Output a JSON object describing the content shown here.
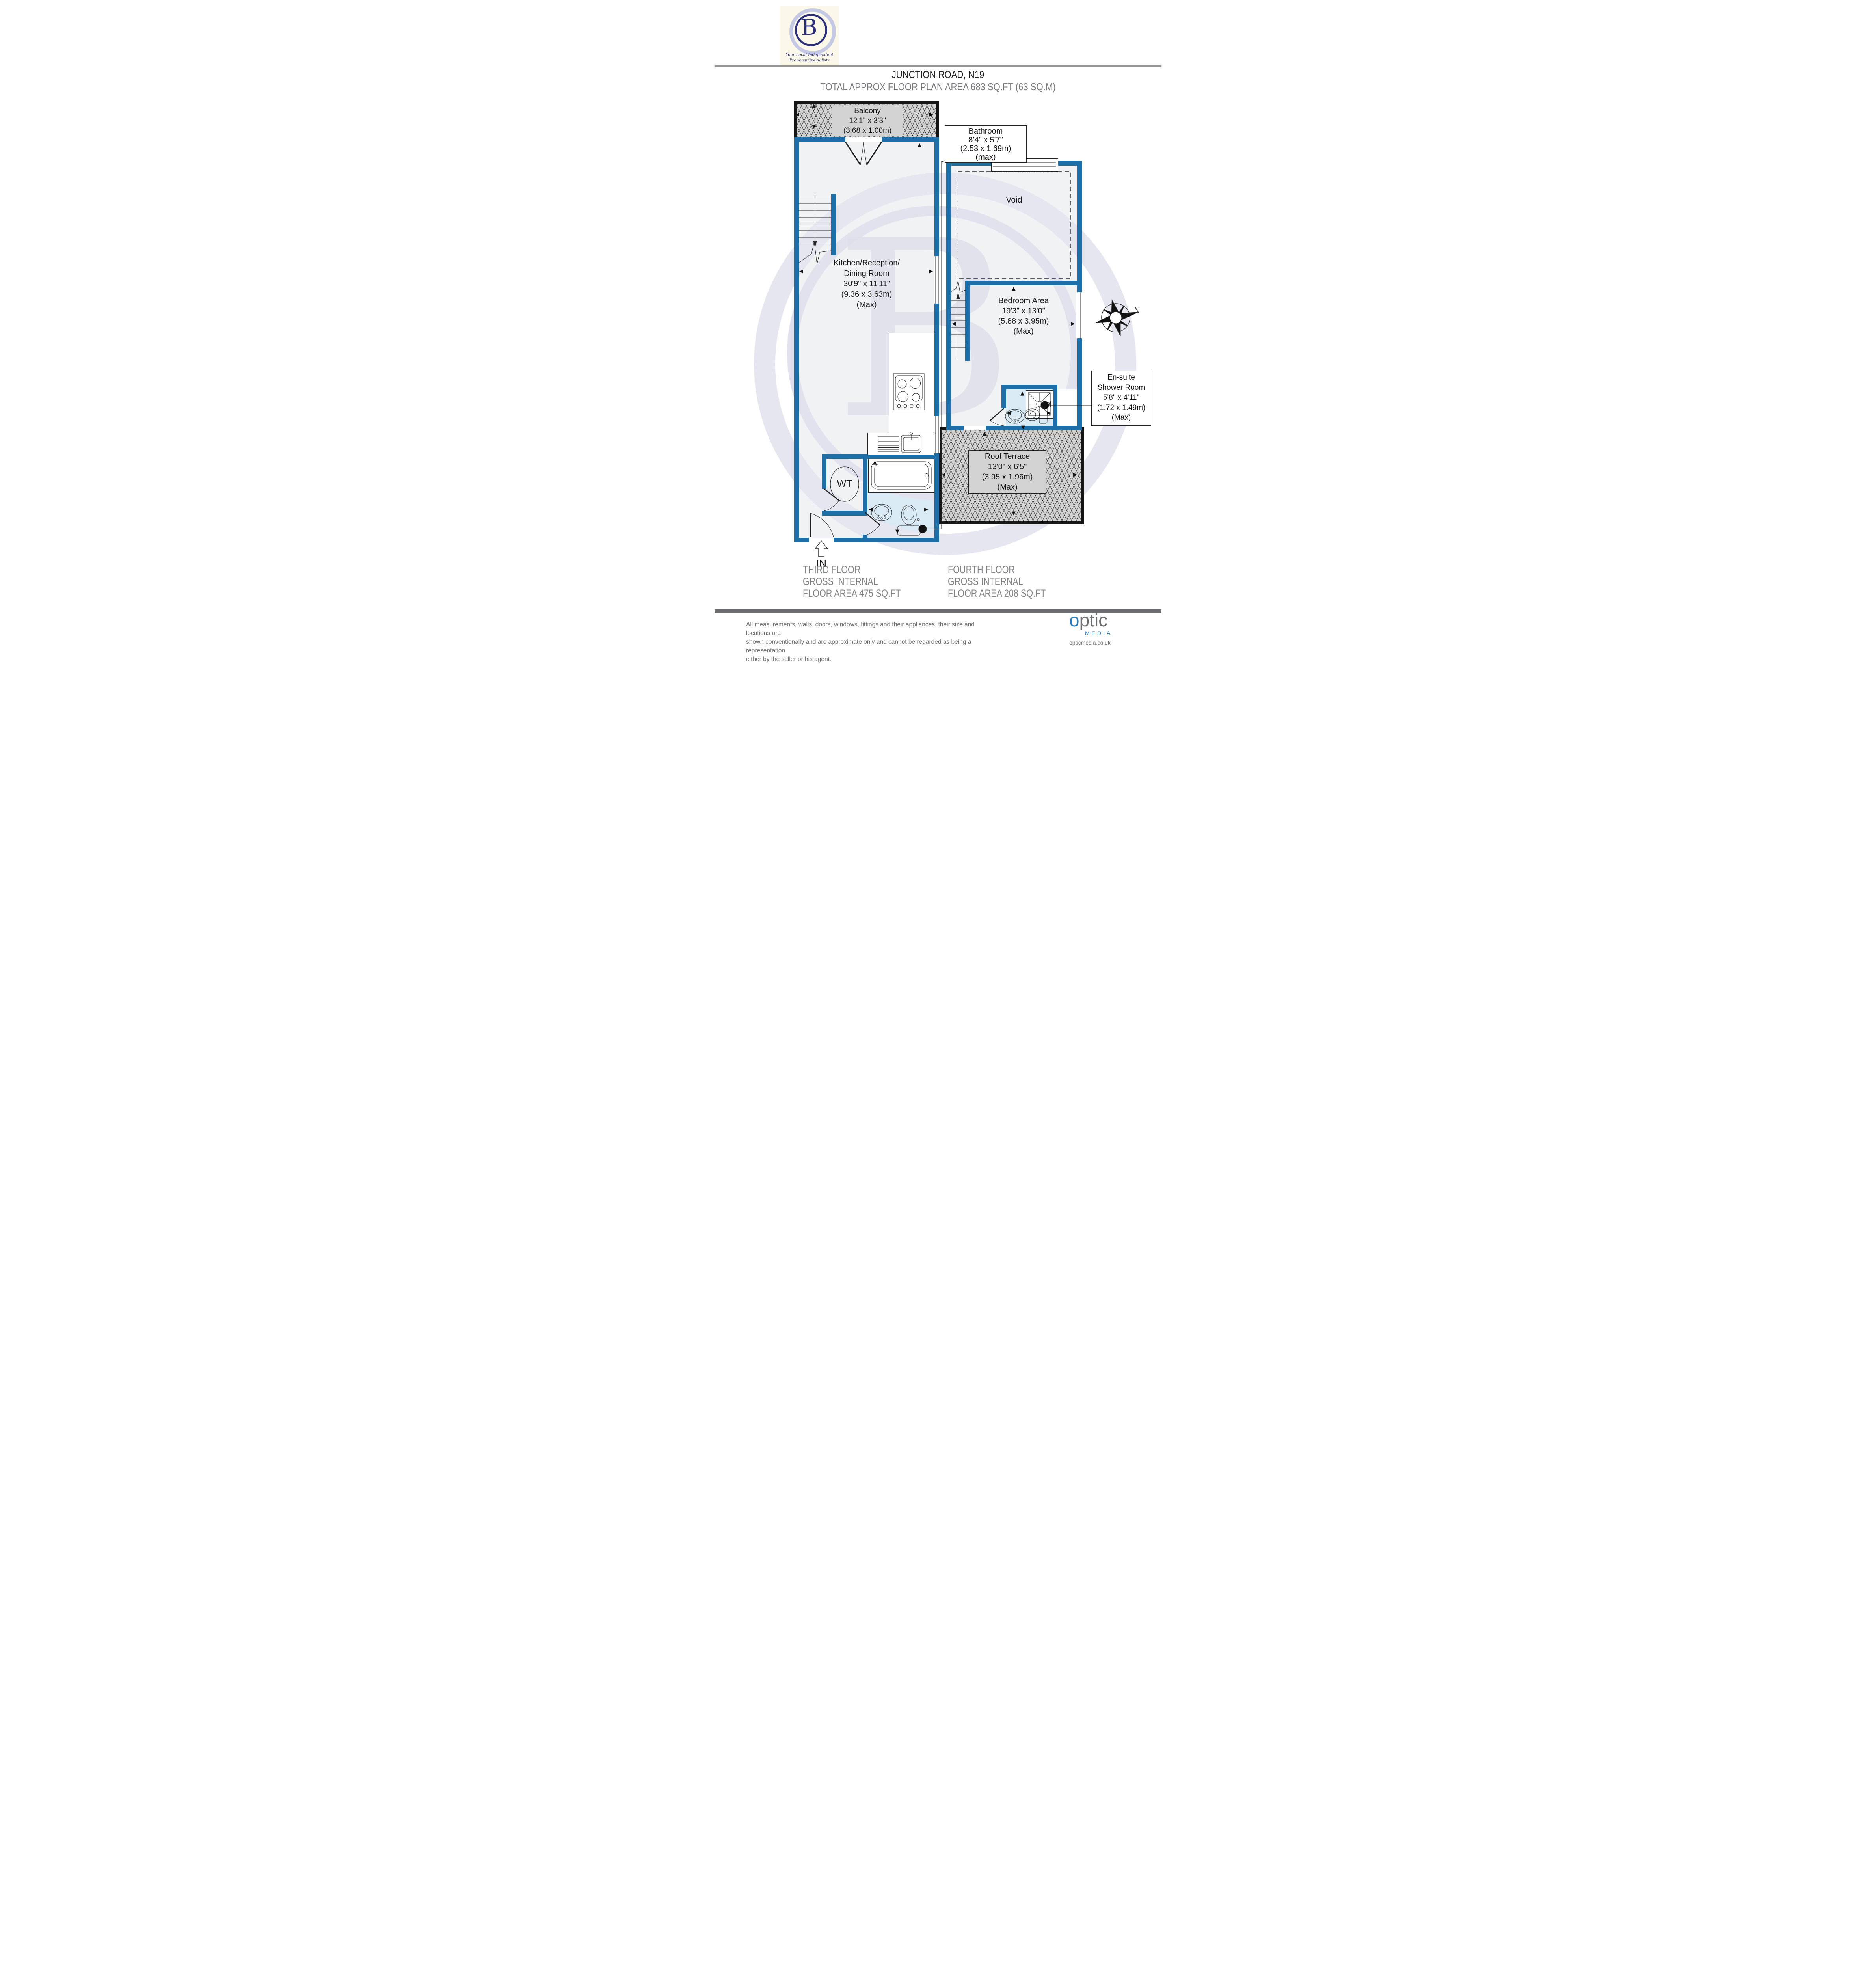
{
  "header": {
    "title": "JUNCTION ROAD, N19",
    "subtitle": "TOTAL APPROX FLOOR PLAN AREA 683 SQ.FT (63 SQ.M)"
  },
  "logo": {
    "letter": "B",
    "tagline1": "Your Local Independent",
    "tagline2": "Property Specialists"
  },
  "compass": {
    "north": "N"
  },
  "floors": {
    "third": {
      "caption": [
        "THIRD FLOOR",
        "GROSS INTERNAL",
        "FLOOR AREA 475 SQ.FT"
      ],
      "entrance": "IN",
      "balcony": {
        "name": "Balcony",
        "imperial": "12'1\" x 3'3\"",
        "metric": "(3.68 x 1.00m)"
      },
      "kitchen": {
        "line1": "Kitchen/Reception/",
        "line2": "Dining Room",
        "imperial": "30'9\" x 11'11\"",
        "metric": "(9.36 x 3.63m)",
        "max": "(Max)"
      },
      "bathroom": {
        "name": "Bathroom",
        "imperial": "8'4\" x 5'7\"",
        "metric": "(2.53 x 1.69m)",
        "max": "(max)"
      },
      "wt": "WT"
    },
    "fourth": {
      "caption": [
        "FOURTH FLOOR",
        "GROSS INTERNAL",
        "FLOOR AREA 208 SQ.FT"
      ],
      "void": "Void",
      "bedroom": {
        "name": "Bedroom Area",
        "imperial": "19'3\" x 13'0\"",
        "metric": "(5.88 x 3.95m)",
        "max": "(Max)"
      },
      "ensuite": {
        "line1": "En-suite",
        "line2": "Shower Room",
        "imperial": "5'8\" x 4'11\"",
        "metric": "(1.72 x 1.49m)",
        "max": "(Max)"
      },
      "terrace": {
        "name": "Roof Terrace",
        "imperial": "13'0\" x 6'5\"",
        "metric": "(3.95 x 1.96m)",
        "max": "(Max)"
      }
    }
  },
  "footer": {
    "disclaimer1": "All measurements, walls, doors, windows, fittings and their appliances, their size and locations are",
    "disclaimer2": "shown conventionally and are approximate only and cannot be regarded as being a representation",
    "disclaimer3": "either by the seller or his agent.",
    "brand": {
      "o": "o",
      "ptic": "ptic",
      "media": "MEDIA",
      "url": "opticmedia.co.uk"
    }
  }
}
